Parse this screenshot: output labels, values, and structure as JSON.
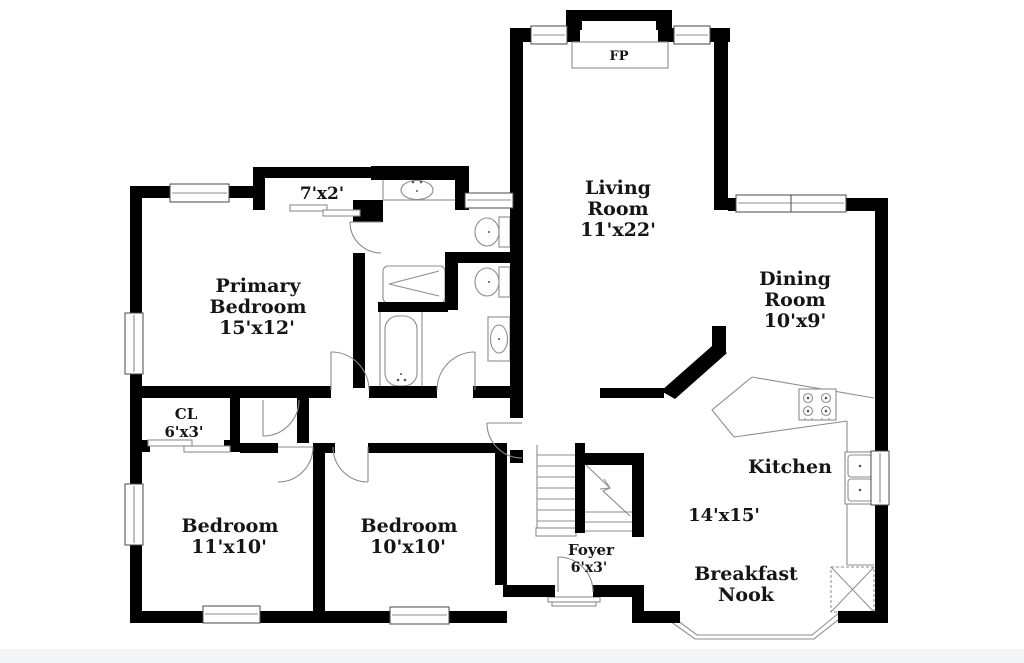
{
  "colors": {
    "wall": "#000000",
    "fixture_line": "#8e8e8e",
    "text": "#151515",
    "background": "#ffffff",
    "frame_strip": "#f3f4f6"
  },
  "rooms": {
    "living": [
      "Living",
      "Room",
      "11'x22'"
    ],
    "dining": [
      "Dining",
      "Room",
      "10'x9'"
    ],
    "primary_bedroom": [
      "Primary",
      "Bedroom",
      "15'x12'"
    ],
    "kitchen": [
      "Kitchen",
      "14'x15'"
    ],
    "breakfast_nook": [
      "Breakfast",
      "Nook"
    ],
    "bedroom_left": [
      "Bedroom",
      "11'x10'"
    ],
    "bedroom_middle": [
      "Bedroom",
      "10'x10'"
    ],
    "foyer": [
      "Foyer",
      "6'x3'"
    ],
    "closet": [
      "CL",
      "6'x3'"
    ],
    "hall_closet": [
      "7'x2'"
    ],
    "fireplace": [
      "FP"
    ]
  },
  "fixtures": [
    "fireplace",
    "bathtub",
    "shower",
    "toilet",
    "sink",
    "double-sink",
    "stove",
    "stairs",
    "bay-window",
    "sliding-closet-doors"
  ]
}
